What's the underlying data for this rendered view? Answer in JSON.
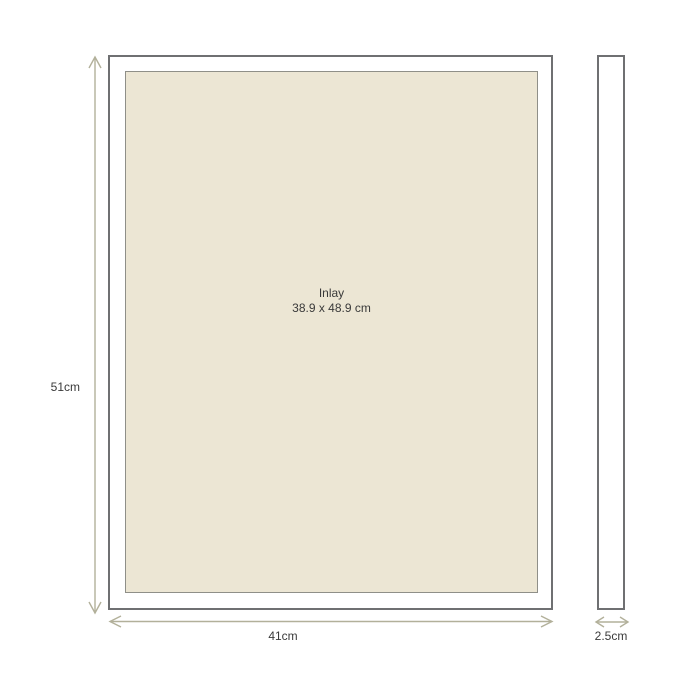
{
  "diagram": {
    "title": "frame-dimension-diagram",
    "inlay": {
      "label": "Inlay",
      "dimensions": "38.9 x 48.9 cm"
    },
    "height_label": "51cm",
    "width_label": "41cm",
    "depth_label": "2.5cm"
  },
  "colors": {
    "background": "#ffffff",
    "frame_border": "#6f7072",
    "inlay_fill": "#ece6d4",
    "inlay_border": "#8f8f88",
    "arrow": "#b2b09a",
    "text": "#3a3a3a"
  }
}
